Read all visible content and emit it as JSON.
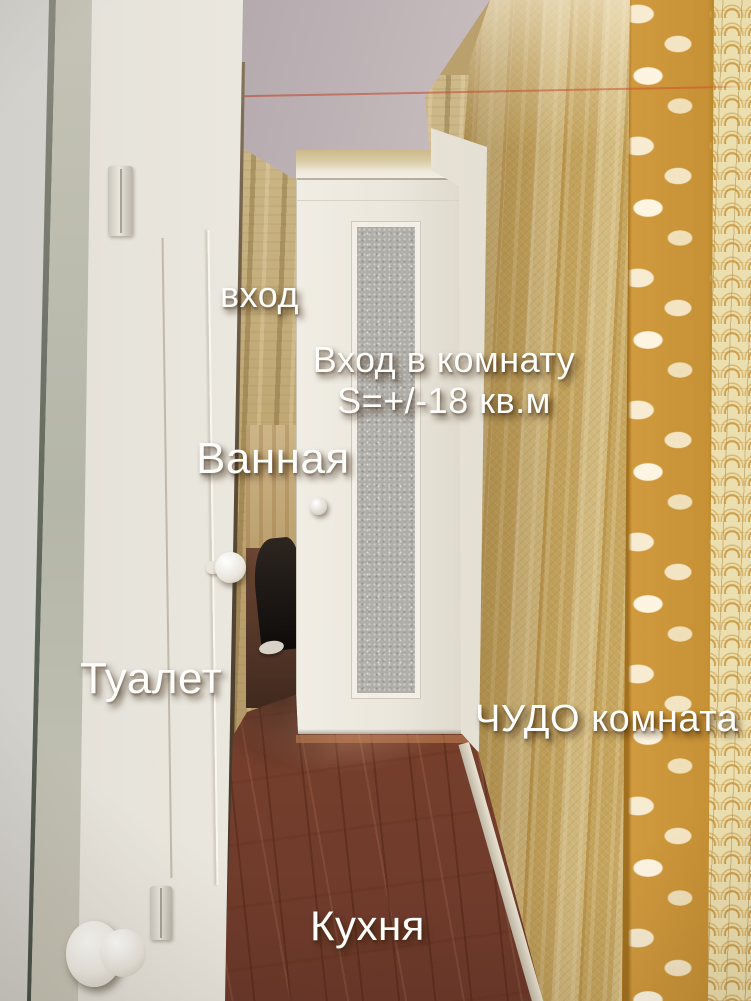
{
  "scene": {
    "description": "Apartment hallway photograph with room annotations",
    "rooms_labeled_count": 6
  },
  "annotations": {
    "entrance": "вход",
    "room_entrance_line1": "Вход в комнату",
    "room_entrance_line2": "S=+/-18 кв.м",
    "bathroom": "Ванная",
    "toilet": "Туалет",
    "miracle_room": "ЧУДО комната",
    "kitchen": "Кухня"
  },
  "palette": {
    "ceiling_grey": "#cfc4c4",
    "gold_wallpaper": "#d2b575",
    "ornament_band_gold": "#dda84a",
    "orange_wallpaper": "#c08049",
    "door_white": "#efece3",
    "floor_brown": "#7c432e",
    "glass_grey": "#b0aea9",
    "wire_red": "#c0462d",
    "annotation_text": "#fdfdfb"
  }
}
